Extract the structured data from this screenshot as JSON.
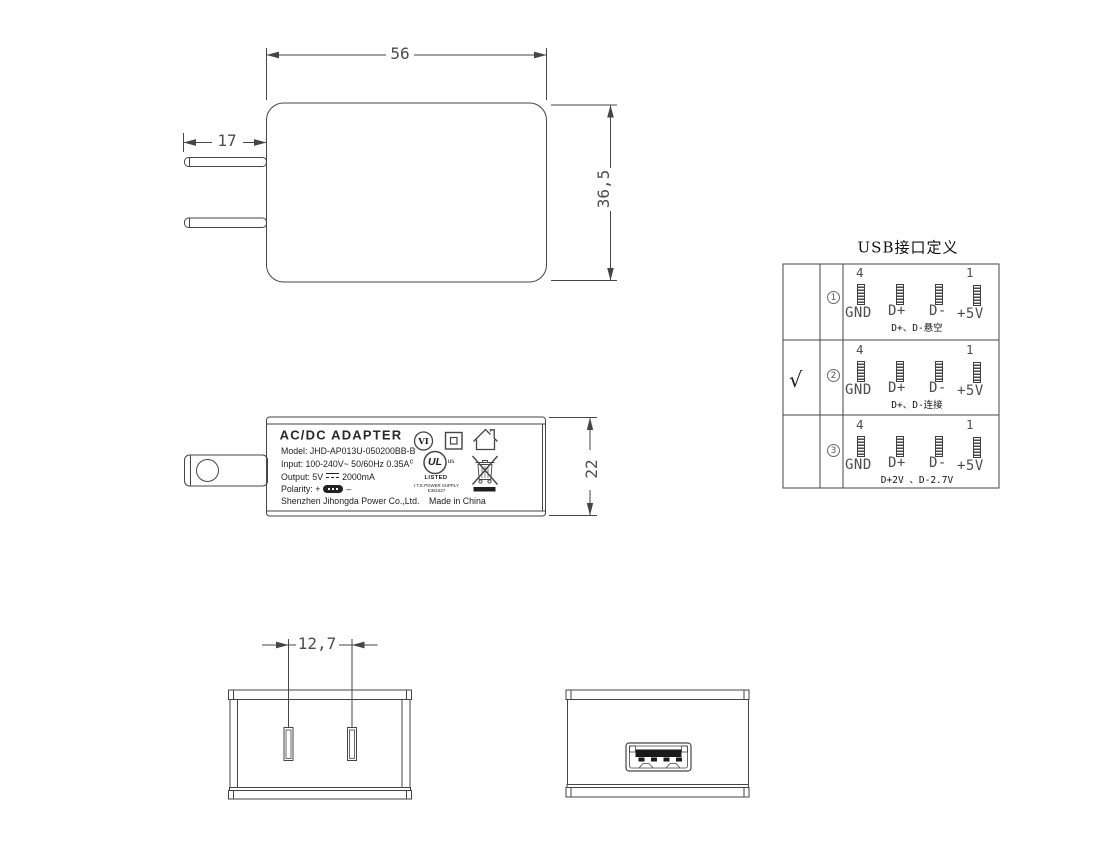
{
  "colors": {
    "line": "#454545",
    "cad_text": "#4d4d4d",
    "label_text": "#222222"
  },
  "front_view": {
    "width_dim": "56",
    "height_dim": "36,5",
    "prong_dim": "17"
  },
  "side_view": {
    "height_dim": "22",
    "label": {
      "title": "AC/DC  ADAPTER",
      "model": "Model: JHD-AP013U-050200BB-B",
      "input": "Input: 100-240V~  50/60Hz  0.35A",
      "output_prefix": "Output: 5V",
      "output_suffix": "2000mA",
      "polarity_label": "Polarity:",
      "plus": "+",
      "minus": "–",
      "company": "Shenzhen Jihongda Power Co.,Ltd.",
      "origin": "Made in China",
      "vi_mark": "VI",
      "ul_c": "c",
      "ul_letters": "UL",
      "ul_us": "us",
      "ul_listed": "LISTED",
      "ul_type": "I.T.E.POWER SUPPLY",
      "ul_file": "E361627"
    }
  },
  "usb_table": {
    "title": "USB接口定义",
    "pin4": "4",
    "pin1": "1",
    "labels": [
      "GND",
      "D+",
      "D-",
      "+5V"
    ],
    "rows": [
      {
        "check": "",
        "num": "1",
        "note": "D+、D-悬空"
      },
      {
        "check": "√",
        "num": "2",
        "note": "D+、D-连接"
      },
      {
        "check": "",
        "num": "3",
        "note": "D+2V 、D-2.7V"
      }
    ]
  },
  "bottom_front_view": {
    "pin_pitch_dim": "12,7"
  }
}
